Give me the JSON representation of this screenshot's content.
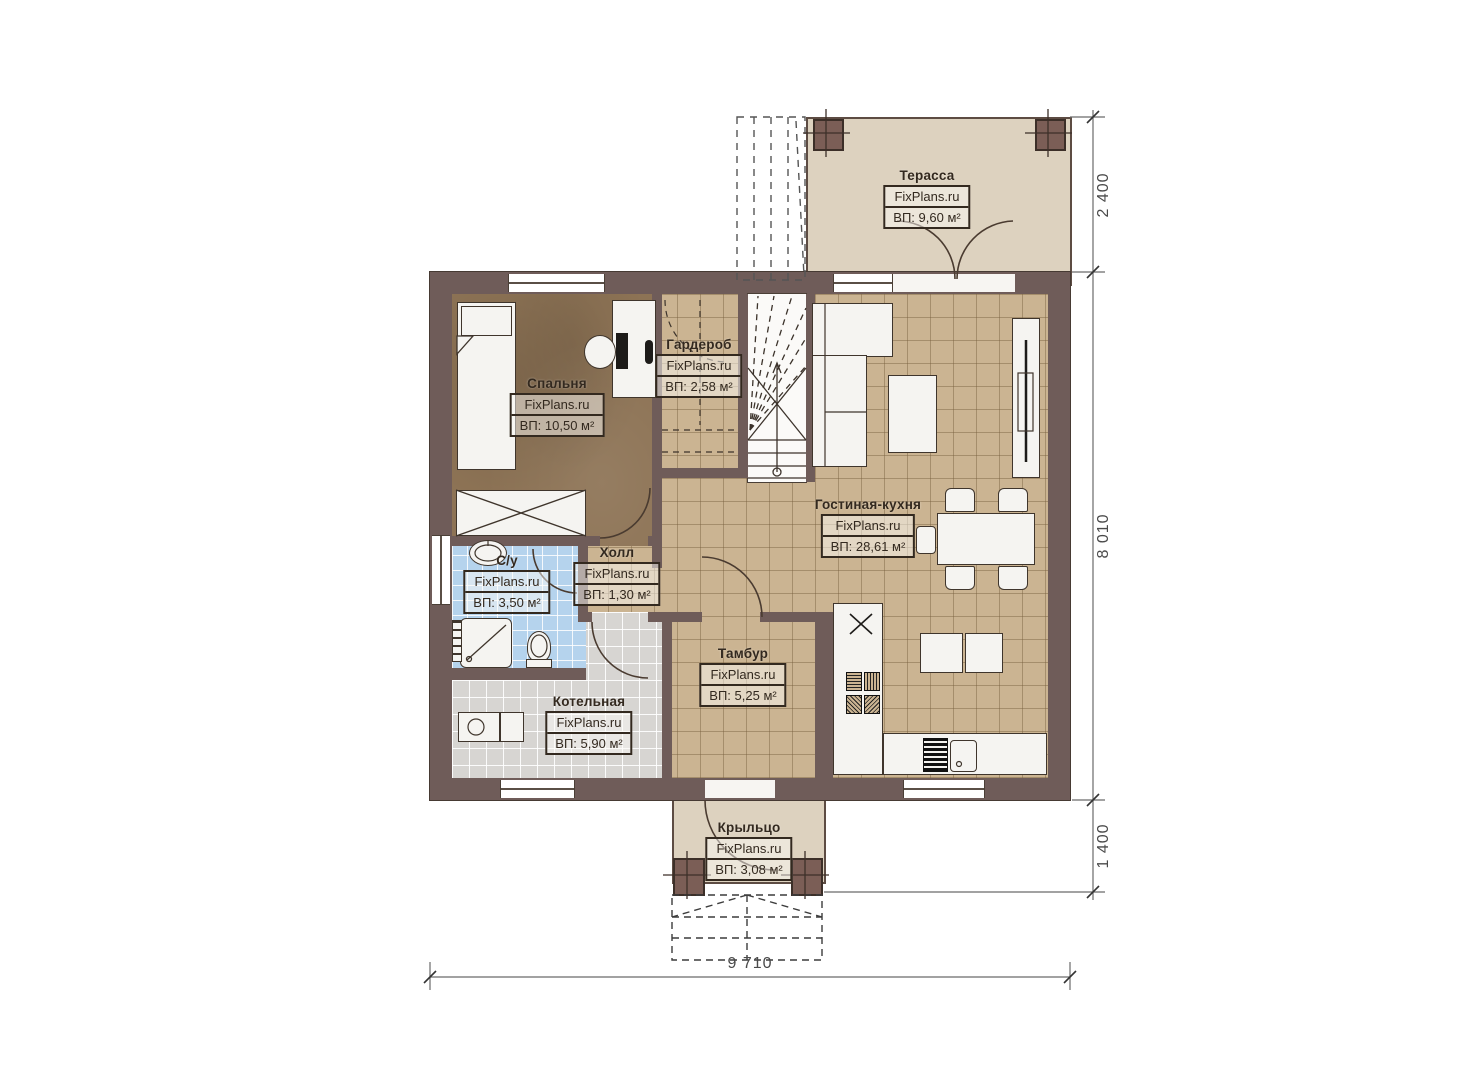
{
  "site": {
    "watermark": "FixPlans.ru"
  },
  "rooms": [
    {
      "id": "terrace",
      "name": "Терасса",
      "watermark": "FixPlans.ru",
      "area": "ВП: 9,60 м²"
    },
    {
      "id": "bedroom",
      "name": "Спальня",
      "watermark": "FixPlans.ru",
      "area": "ВП: 10,50 м²"
    },
    {
      "id": "wardrobe",
      "name": "Гардероб",
      "watermark": "FixPlans.ru",
      "area": "ВП: 2,58 м²"
    },
    {
      "id": "living-kitchen",
      "name": "Гостиная-кухня",
      "watermark": "FixPlans.ru",
      "area": "ВП: 28,61 м²"
    },
    {
      "id": "hall",
      "name": "Холл",
      "watermark": "FixPlans.ru",
      "area": "ВП: 1,30 м²"
    },
    {
      "id": "bathroom",
      "name": "С/у",
      "watermark": "FixPlans.ru",
      "area": "ВП: 3,50 м²"
    },
    {
      "id": "boiler",
      "name": "Котельная",
      "watermark": "FixPlans.ru",
      "area": "ВП: 5,90 м²"
    },
    {
      "id": "tambour",
      "name": "Тамбур",
      "watermark": "FixPlans.ru",
      "area": "ВП: 5,25 м²"
    },
    {
      "id": "porch",
      "name": "Крыльцо",
      "watermark": "FixPlans.ru",
      "area": "ВП: 3,08 м²"
    }
  ],
  "dimensions": {
    "terrace_depth": "2 400",
    "house_depth": "8 010",
    "porch_depth": "1 400",
    "house_width": "9 710"
  },
  "colors": {
    "wall": "#6f5c59",
    "floor_tile": "#cbb492",
    "floor_bedroom": "#8d7355",
    "floor_bathroom": "#b5d3ed",
    "floor_boiler": "#d7d5d2",
    "outdoor": "#ddd2bf",
    "column": "#7b5e56"
  }
}
